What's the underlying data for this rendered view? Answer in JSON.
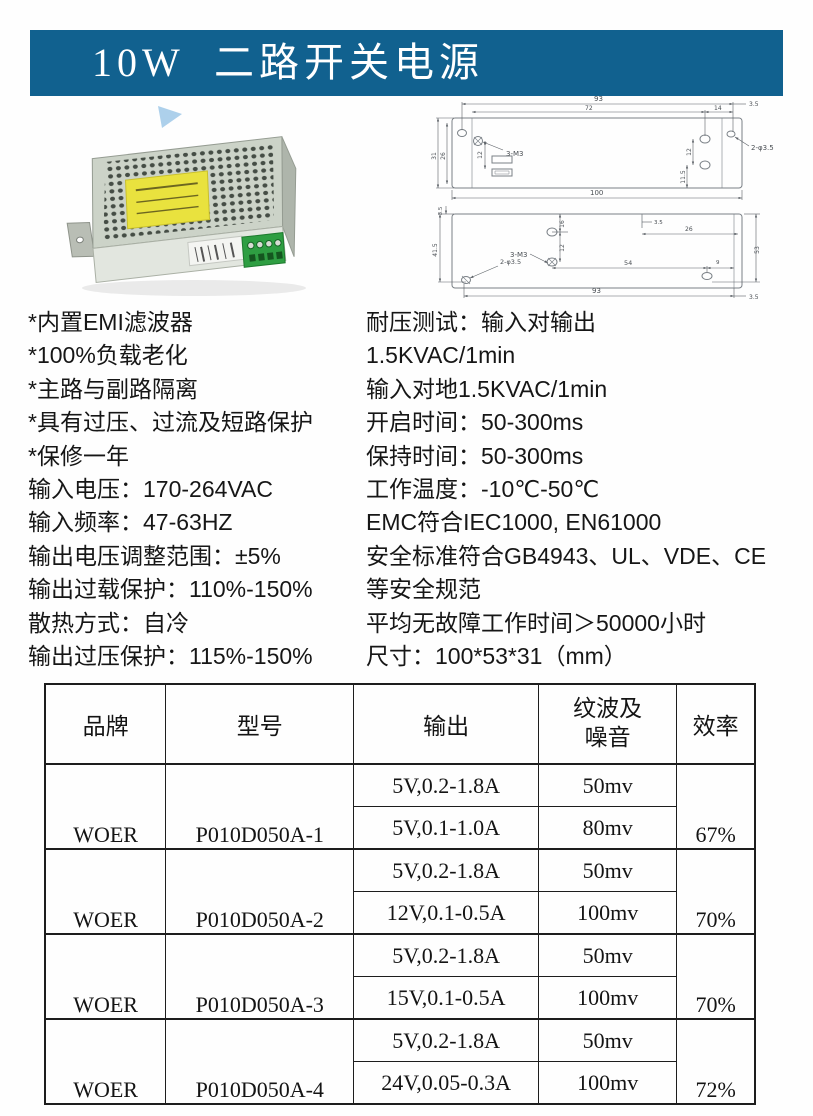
{
  "header": {
    "title": "10W  二路开关电源"
  },
  "colors": {
    "header_bg": "#11618f",
    "header_fg": "#ffffff",
    "case_green": "#2e9e42",
    "label_yellow": "#e9e23e"
  },
  "photo": {
    "description": "dual-output enclosed switching power supply, perforated metal case, yellow label, green terminal block"
  },
  "drawings": {
    "top_view": {
      "labels": [
        "93",
        "72",
        "14",
        "3.5",
        "31",
        "26",
        "12",
        "3-M3",
        "12",
        "11.5",
        "2-φ3.5",
        "100"
      ]
    },
    "bottom_view": {
      "labels": [
        "3.5",
        "41.5",
        "16",
        "12",
        "3-M3",
        "3.5",
        "26",
        "53",
        "54",
        "9",
        "2-φ3.5",
        "93",
        "3.5"
      ]
    }
  },
  "specs": {
    "left": [
      "*内置EMI滤波器",
      "*100%负载老化",
      "*主路与副路隔离",
      "*具有过压、过流及短路保护",
      "*保修一年",
      "输入电压：170-264VAC",
      "输入频率：47-63HZ",
      "输出电压调整范围：±5%",
      "输出过载保护：110%-150%",
      "散热方式：自冷",
      "输出过压保护：115%-150%"
    ],
    "right": [
      "耐压测试：输入对输出",
      "1.5KVAC/1min",
      "输入对地1.5KVAC/1min",
      "开启时间：50-300ms",
      "保持时间：50-300ms",
      "工作温度：-10℃-50℃",
      "EMC符合IEC1000, EN61000",
      "安全标准符合GB4943、UL、VDE、CE",
      "等安全规范",
      "平均无故障工作时间＞50000小时",
      "尺寸：100*53*31（mm）"
    ]
  },
  "table": {
    "headers": [
      "品牌",
      "型号",
      "输出",
      "纹波及\n噪音",
      "效率"
    ],
    "groups": [
      {
        "brand": "WOER",
        "model": "P010D050A-1",
        "efficiency": "67%",
        "rows": [
          {
            "output": "5V,0.2-1.8A",
            "ripple": "50mv"
          },
          {
            "output": "5V,0.1-1.0A",
            "ripple": "80mv"
          }
        ]
      },
      {
        "brand": "WOER",
        "model": "P010D050A-2",
        "efficiency": "70%",
        "rows": [
          {
            "output": "5V,0.2-1.8A",
            "ripple": "50mv"
          },
          {
            "output": "12V,0.1-0.5A",
            "ripple": "100mv"
          }
        ]
      },
      {
        "brand": "WOER",
        "model": "P010D050A-3",
        "efficiency": "70%",
        "rows": [
          {
            "output": "5V,0.2-1.8A",
            "ripple": "50mv"
          },
          {
            "output": "15V,0.1-0.5A",
            "ripple": "100mv"
          }
        ]
      },
      {
        "brand": "WOER",
        "model": "P010D050A-4",
        "efficiency": "72%",
        "rows": [
          {
            "output": "5V,0.2-1.8A",
            "ripple": "50mv"
          },
          {
            "output": "24V,0.05-0.3A",
            "ripple": "100mv"
          }
        ]
      }
    ]
  }
}
